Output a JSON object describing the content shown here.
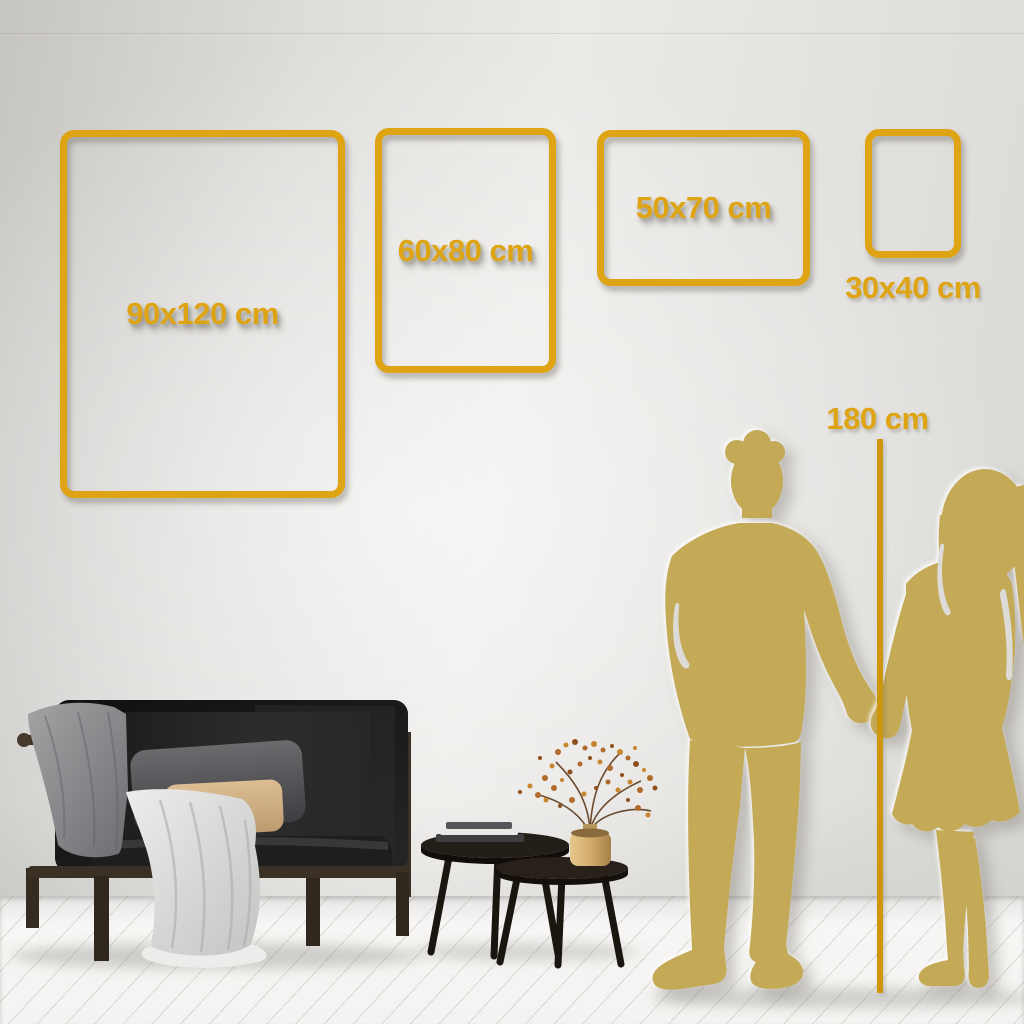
{
  "size_guide": {
    "accent_color": "#DFA414",
    "line_color": "#CC970C",
    "silhouette_color": "#C4A957",
    "frames": [
      {
        "id": "90x120",
        "label": "90x120 cm"
      },
      {
        "id": "60x80",
        "label": "60x80 cm"
      },
      {
        "id": "50x70",
        "label": "50x70 cm"
      },
      {
        "id": "30x40",
        "label": "30x40 cm"
      }
    ],
    "height_marker": {
      "label": "180 cm"
    }
  },
  "scene": {
    "wall_color": "#E3E2DF",
    "floor_color": "#F4F3F1",
    "decor_icons": [
      "sofa-icon",
      "blanket-icon",
      "gray-pillow-icon",
      "tan-pillow-icon",
      "white-throw-icon",
      "nesting-tables-icon",
      "books-icon",
      "brass-vase-icon",
      "dried-branch-icon"
    ],
    "figure_icons": [
      "man-silhouette-icon",
      "woman-silhouette-icon"
    ]
  }
}
